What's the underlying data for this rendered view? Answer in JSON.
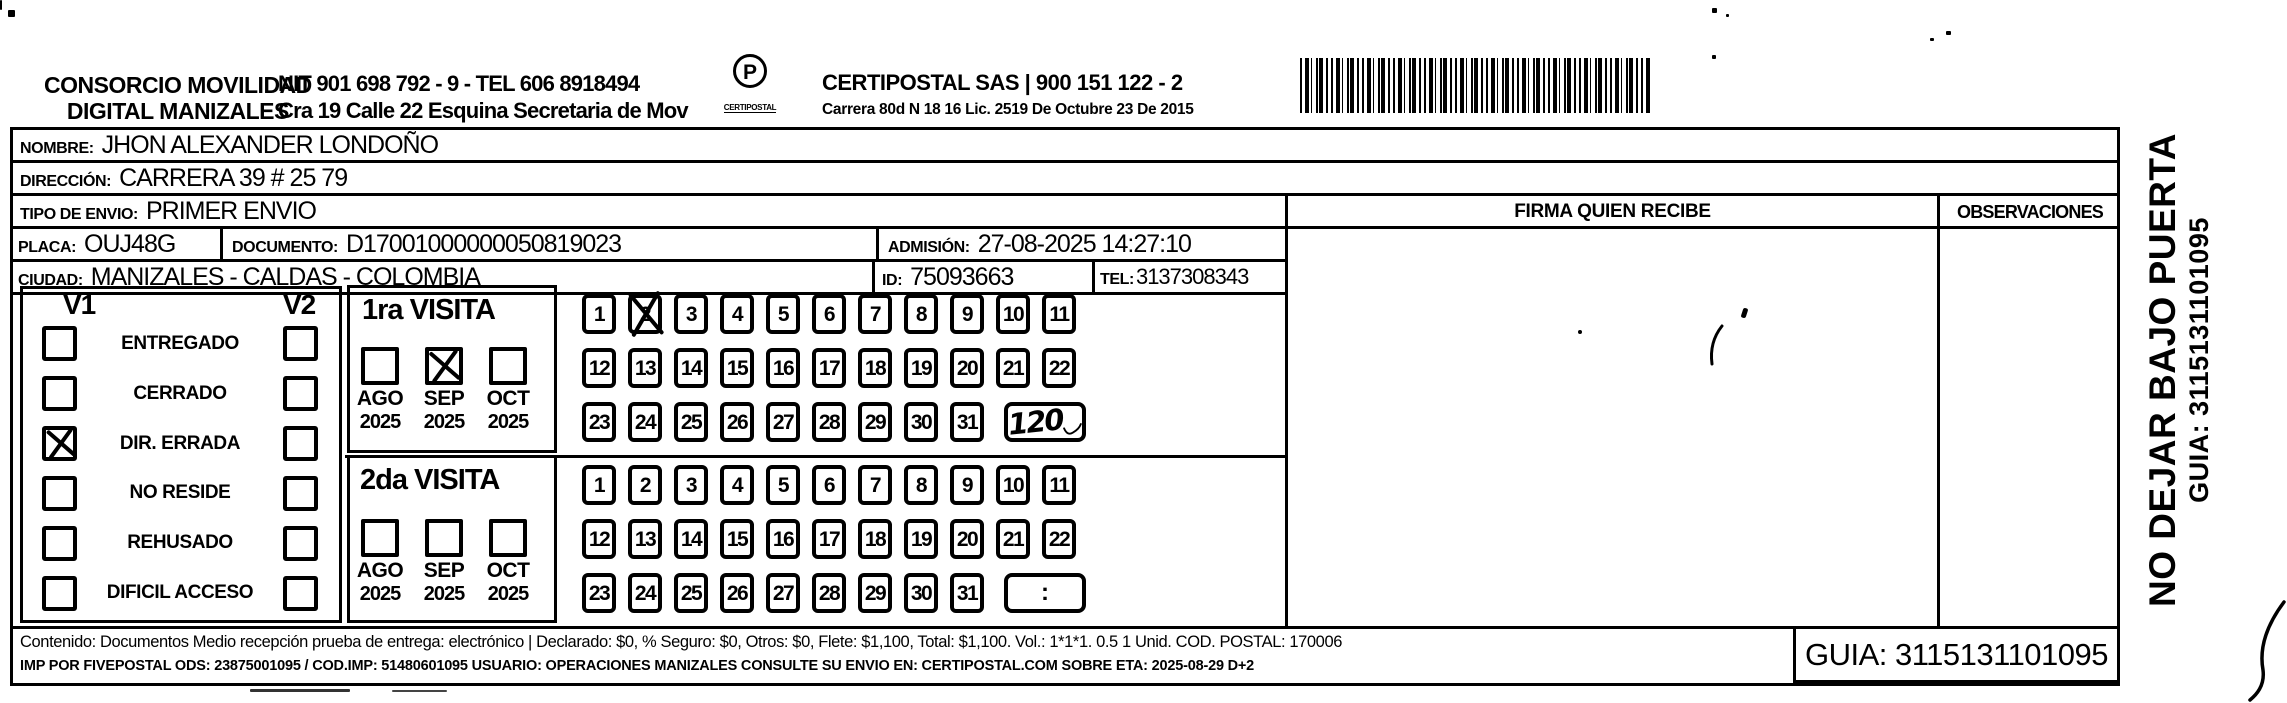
{
  "header": {
    "consorcio_line1": "CONSORCIO MOVILIDAD",
    "consorcio_line2": "DIGITAL MANIZALES",
    "nit_line1": "NIT 901 698 792 - 9 - TEL 606 8918494",
    "nit_line2": "Cra 19 Calle 22 Esquina Secretaria de Mov",
    "logo_caption": "CERTIPOSTAL",
    "certipostal_line1": "CERTIPOSTAL SAS | 900 151 122 - 2",
    "certipostal_line2": "Carrera 80d N 18 16 Lic. 2519 De Octubre 23 De 2015"
  },
  "form": {
    "nombre_label": "NOMBRE:",
    "nombre": "JHON ALEXANDER LONDOÑO",
    "direccion_label": "DIRECCIÓN:",
    "direccion": "CARRERA 39 # 25 79",
    "tipo_envio_label": "TIPO DE ENVIO:",
    "tipo_envio": "PRIMER ENVIO",
    "placa_label": "PLACA:",
    "placa": "OUJ48G",
    "documento_label": "DOCUMENTO:",
    "documento": "D17001000000050819023",
    "admision_label": "ADMISIÓN:",
    "admision": "27-08-2025 14:27:10",
    "ciudad_label": "CIUDAD:",
    "ciudad": "MANIZALES - CALDAS - COLOMBIA",
    "id_label": "ID:",
    "id": "75093663",
    "tel_label": "TEL:",
    "tel": "3137308343",
    "firma_header": "FIRMA QUIEN RECIBE",
    "observaciones_header": "OBSERVACIONES"
  },
  "status_panel": {
    "v1_label": "V1",
    "v2_label": "V2",
    "rows": [
      {
        "label": "ENTREGADO",
        "v1_checked": false,
        "v2_checked": false
      },
      {
        "label": "CERRADO",
        "v1_checked": false,
        "v2_checked": false
      },
      {
        "label": "DIR. ERRADA",
        "v1_checked": true,
        "v2_checked": false
      },
      {
        "label": "NO RESIDE",
        "v1_checked": false,
        "v2_checked": false
      },
      {
        "label": "REHUSADO",
        "v1_checked": false,
        "v2_checked": false
      },
      {
        "label": "DIFICIL ACCESO",
        "v1_checked": false,
        "v2_checked": false
      }
    ]
  },
  "visits": [
    {
      "title": "1ra VISITA",
      "months": [
        {
          "month": "AGO",
          "year": "2025",
          "checked": false
        },
        {
          "month": "SEP",
          "year": "2025",
          "checked": true
        },
        {
          "month": "OCT",
          "year": "2025",
          "checked": false
        }
      ],
      "day_rows": [
        [
          1,
          2,
          3,
          4,
          5,
          6,
          7,
          8,
          9,
          10,
          11
        ],
        [
          12,
          13,
          14,
          15,
          16,
          17,
          18,
          19,
          20,
          21,
          22
        ],
        [
          23,
          24,
          25,
          26,
          27,
          28,
          29,
          30,
          31
        ]
      ],
      "crossed_days": [
        2
      ],
      "tail_box": {
        "handwritten": "120",
        "swoosh": true
      }
    },
    {
      "title": "2da VISITA",
      "months": [
        {
          "month": "AGO",
          "year": "2025",
          "checked": false
        },
        {
          "month": "SEP",
          "year": "2025",
          "checked": false
        },
        {
          "month": "OCT",
          "year": "2025",
          "checked": false
        }
      ],
      "day_rows": [
        [
          1,
          2,
          3,
          4,
          5,
          6,
          7,
          8,
          9,
          10,
          11
        ],
        [
          12,
          13,
          14,
          15,
          16,
          17,
          18,
          19,
          20,
          21,
          22
        ],
        [
          23,
          24,
          25,
          26,
          27,
          28,
          29,
          30,
          31
        ]
      ],
      "crossed_days": [],
      "tail_box": {
        "text": ":"
      }
    }
  ],
  "footer": {
    "contenido_line": "Contenido: Documentos Medio recepción prueba de entrega: electrónico | Declarado: $0, % Seguro: $0, Otros: $0, Flete: $1,100, Total: $1,100. Vol.: 1*1*1. 0.5 1 Unid. COD. POSTAL: 170006",
    "imp_line": "IMP POR FIVEPOSTAL ODS: 23875001095 / COD.IMP: 51480601095 USUARIO: OPERACIONES MANIZALES CONSULTE SU ENVIO EN: CERTIPOSTAL.COM SOBRE ETA: 2025-08-29 D+2",
    "guia_box": "GUIA: 3115131101095"
  },
  "side_text": {
    "line1": "NO DEJAR BAJO PUERTA",
    "line2": "GUIA: 3115131101095"
  }
}
